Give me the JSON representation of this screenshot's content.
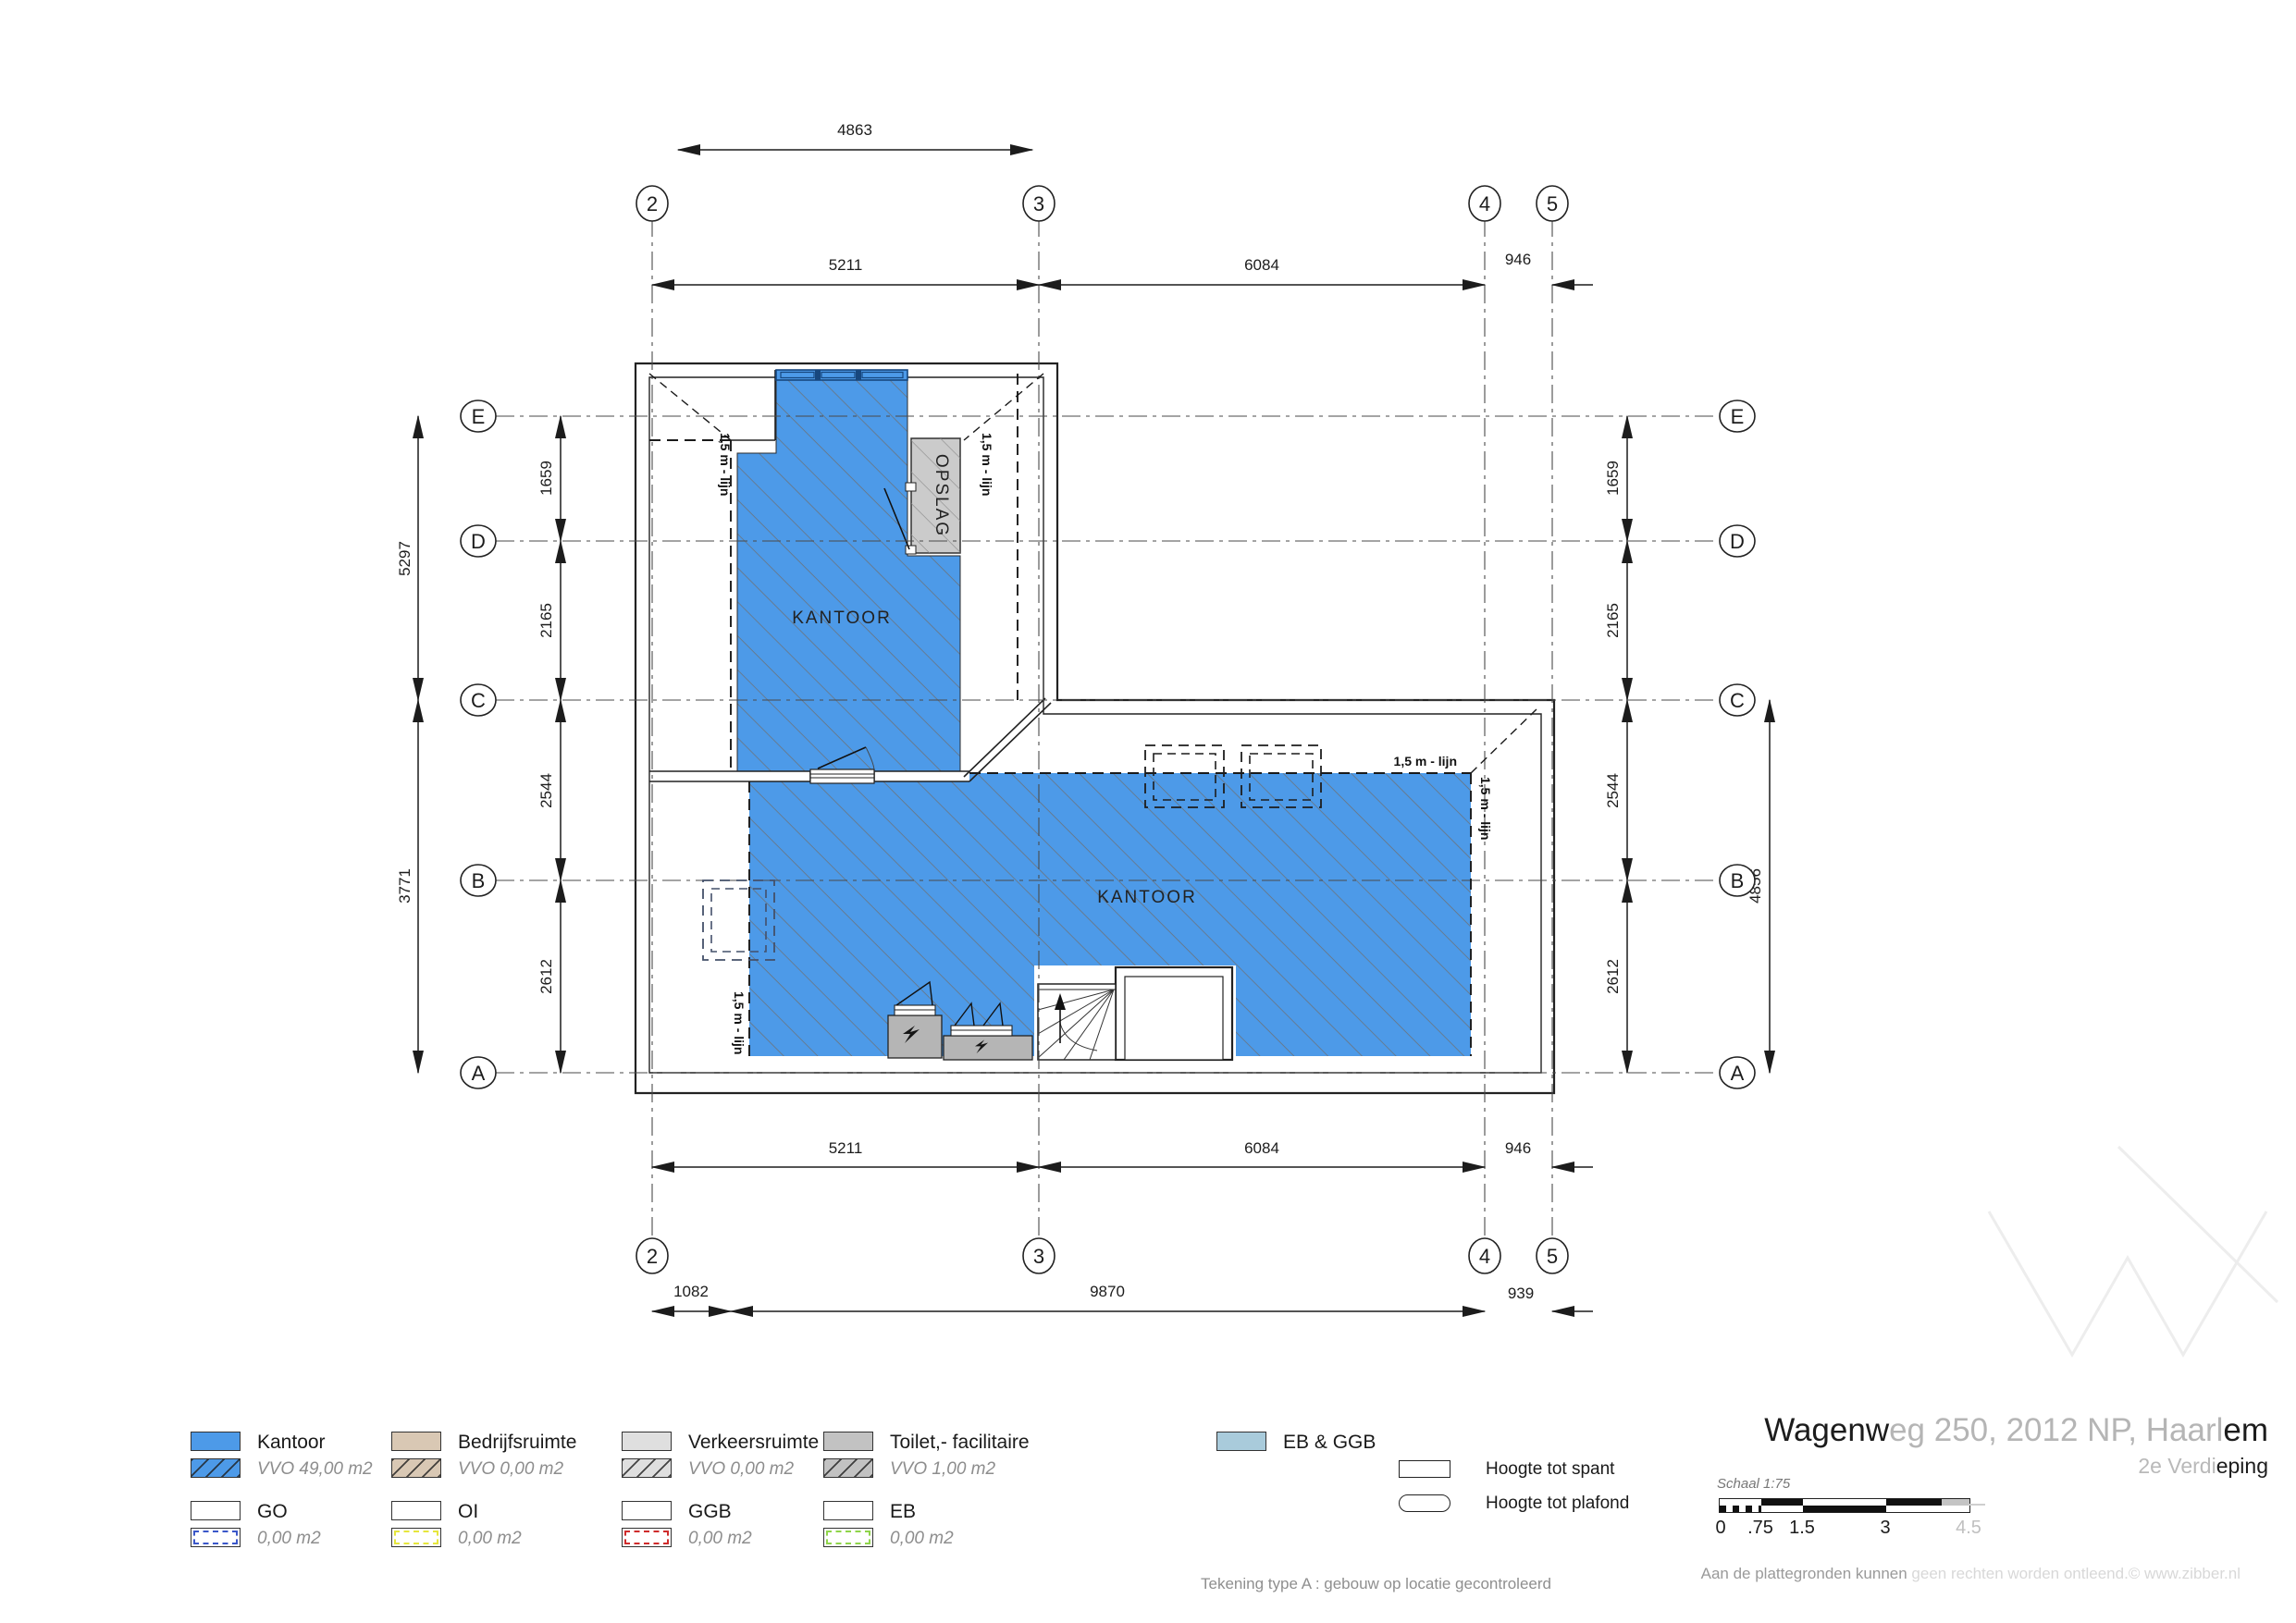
{
  "plan": {
    "grid_cols": [
      "2",
      "3",
      "4",
      "5"
    ],
    "grid_rows": [
      "E",
      "D",
      "C",
      "B",
      "A"
    ],
    "rooms": {
      "kantoor_upper": "KANTOOR",
      "kantoor_lower": "KANTOOR",
      "opslag": "OPSLAG"
    },
    "line_label": "1,5 m - lijn",
    "dims": {
      "top_overall": "4863",
      "c23": "5211",
      "c34": "6084",
      "c45": "946",
      "b23": "5211",
      "b34": "6084",
      "b45": "946",
      "b2_left": "1082",
      "b2_mid": "9870",
      "b2_right": "939",
      "left_ec": "5297",
      "left_ca": "3771",
      "ed": "1659",
      "dc": "2165",
      "cb": "2544",
      "ba": "2612",
      "right_ca": "4856"
    }
  },
  "legend": {
    "items": [
      {
        "label": "Kantoor",
        "vvo": "VVO 49,00 m2"
      },
      {
        "label": "Bedrijfsruimte",
        "vvo": "VVO 0,00 m2"
      },
      {
        "label": "Verkeersruimte",
        "vvo": "VVO 0,00 m2"
      },
      {
        "label": "Toilet,- facilitaire",
        "vvo": "VVO 1,00 m2"
      }
    ],
    "items2": [
      {
        "label": "GO",
        "value": "0,00 m2"
      },
      {
        "label": "OI",
        "value": "0,00 m2"
      },
      {
        "label": "GGB",
        "value": "0,00 m2"
      },
      {
        "label": "EB",
        "value": "0,00 m2"
      }
    ],
    "eb_ggb": "EB & GGB",
    "hoogte_spant": "Hoogte tot spant",
    "hoogte_plafond": "Hoogte tot plafond"
  },
  "title": {
    "part1": "Wagenw",
    "part2": "eg 250, 2012 NP, Haarl",
    "part3": "em",
    "sub1": "2e Verdi",
    "sub2": "eping"
  },
  "scalebar": {
    "label": "Schaal 1:75",
    "ticks": [
      "0",
      ".75",
      "1.5",
      "3",
      "4.5"
    ]
  },
  "notes": {
    "tekening": "Tekening type A : gebouw op locatie gecontroleerd",
    "rights_dark": "Aan de plattegronden kunnen",
    "rights_light": " geen rechten worden ontleend.",
    "rights_brand": "© www.zibber.nl"
  },
  "colors": {
    "kantoor": "#4D9AE8",
    "bedrijfsruimte": "#D9C8B4",
    "verkeersruimte": "#DFDFDF",
    "toilet": "#C2C2C2",
    "opslag": "#CBCBCB",
    "elec": "#B5B5B5",
    "eb_ggb": "#A9CBDB",
    "go_dash": "#3A57C9",
    "oi_dash": "#E6E63C",
    "ggb_dash": "#CF2B2B",
    "eb_dash": "#8FD54A"
  }
}
